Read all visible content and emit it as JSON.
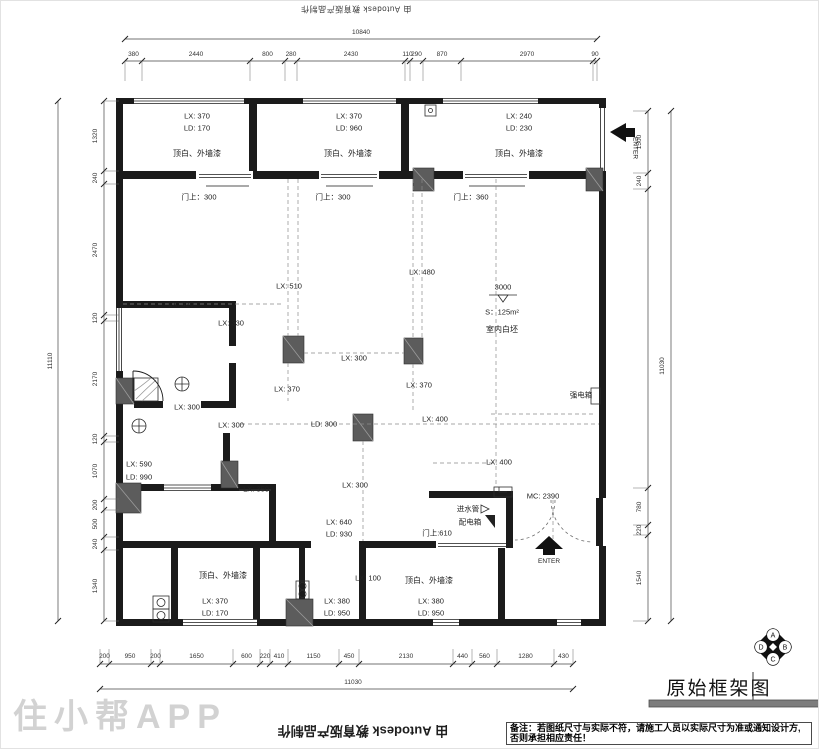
{
  "colors": {
    "wall": "#1b1b1b",
    "column": "#5c5c5c",
    "dimension": "#444444",
    "dashed_ref": "#8a8a8a",
    "title_bar": "#7d7d7d",
    "watermark": "#d2d2d2"
  },
  "watermarks": {
    "autodesk": "由 Autodesk 教育版产品制作",
    "app": "住小帮APP"
  },
  "title_block": {
    "title": "原始框架图",
    "logo_letters": [
      "A",
      "B",
      "C",
      "D"
    ],
    "note": "备注：若图纸尺寸与实际不符，请施工人员以实际尺寸为准或通知设计方,否则承担相应责任！"
  },
  "dimensions": {
    "top": {
      "total": "10840",
      "segments": [
        "380",
        "2440",
        "800",
        "280",
        "2430",
        "110",
        "290",
        "870",
        "2970",
        "90"
      ]
    },
    "bottom": {
      "total": "11030",
      "segments": [
        "200",
        "950",
        "200",
        "1650",
        "600",
        "220",
        "410",
        "1150",
        "450",
        "2130",
        "440",
        "560",
        "1280",
        "430"
      ]
    },
    "left": {
      "total": "11110",
      "segments": [
        "1320",
        "240",
        "2470",
        "120",
        "2170",
        "120",
        "1070",
        "200",
        "500",
        "240",
        "1340"
      ]
    },
    "right": {
      "total": "11030",
      "segments": [
        "1500",
        "240",
        "",
        "780",
        "220",
        "1540"
      ]
    }
  },
  "plan_labels": [
    {
      "name": "room1-lx",
      "t": "LX: 370",
      "x": 196,
      "y": 115
    },
    {
      "name": "room1-ld",
      "t": "LD: 170",
      "x": 196,
      "y": 127
    },
    {
      "name": "room1-finish",
      "t": "顶白、外墙漆",
      "x": 196,
      "y": 153,
      "size": 8
    },
    {
      "name": "room1-door-height",
      "t": "门上：300",
      "x": 198,
      "y": 196
    },
    {
      "name": "room2-lx",
      "t": "LX: 370",
      "x": 348,
      "y": 115
    },
    {
      "name": "room2-ld",
      "t": "LD: 960",
      "x": 348,
      "y": 127
    },
    {
      "name": "room2-finish",
      "t": "顶白、外墙漆",
      "x": 347,
      "y": 153,
      "size": 8
    },
    {
      "name": "room2-door-height",
      "t": "门上：300",
      "x": 332,
      "y": 196
    },
    {
      "name": "room3-lx",
      "t": "LX: 240",
      "x": 518,
      "y": 115
    },
    {
      "name": "room3-ld",
      "t": "LD: 230",
      "x": 518,
      "y": 127
    },
    {
      "name": "room3-finish",
      "t": "顶白、外墙漆",
      "x": 518,
      "y": 153,
      "size": 8
    },
    {
      "name": "room3-door-height",
      "t": "门上：360",
      "x": 470,
      "y": 196
    },
    {
      "name": "enter-top-label",
      "t": "ENTER",
      "x": 633,
      "y": 147,
      "rot": 90,
      "size": 6.5
    },
    {
      "name": "dim-lx-320",
      "t": "LX: 320",
      "x": 180,
      "y": 303
    },
    {
      "name": "dim-lx-330",
      "t": "LX: 330",
      "x": 230,
      "y": 322
    },
    {
      "name": "dim-lx-300-a",
      "t": "LX: 300",
      "x": 186,
      "y": 406
    },
    {
      "name": "dim-lx-300-b",
      "t": "LX: 300",
      "x": 230,
      "y": 424
    },
    {
      "name": "dim-lx-590",
      "t": "LX: 590",
      "x": 138,
      "y": 463
    },
    {
      "name": "dim-ld-990",
      "t": "LD: 990",
      "x": 138,
      "y": 476
    },
    {
      "name": "dim-lx-350",
      "t": "LX: 350",
      "x": 255,
      "y": 488
    },
    {
      "name": "dim-lx-510",
      "t": "LX: 510",
      "x": 288,
      "y": 285
    },
    {
      "name": "dim-lx-480",
      "t": "LX: 480",
      "x": 421,
      "y": 271
    },
    {
      "name": "dim-lx-300-mid",
      "t": "LX: 300",
      "x": 353,
      "y": 357
    },
    {
      "name": "dim-lx-370-c1",
      "t": "LX: 370",
      "x": 286,
      "y": 388
    },
    {
      "name": "dim-lx-370-c2",
      "t": "LX: 370",
      "x": 418,
      "y": 384
    },
    {
      "name": "elevation-value",
      "t": "3000",
      "x": 502,
      "y": 286
    },
    {
      "name": "area-value",
      "t": "S：125m²",
      "x": 501,
      "y": 311
    },
    {
      "name": "interior-finish",
      "t": "室内白坯",
      "x": 501,
      "y": 329,
      "size": 8
    },
    {
      "name": "dim-ld-300",
      "t": "LD: 300",
      "x": 323,
      "y": 423
    },
    {
      "name": "dim-lx-400-a",
      "t": "LX: 400",
      "x": 434,
      "y": 418
    },
    {
      "name": "dim-lx-400-b",
      "t": "LX: 400",
      "x": 498,
      "y": 461
    },
    {
      "name": "dim-lx-300-c",
      "t": "LX: 300",
      "x": 354,
      "y": 484
    },
    {
      "name": "dim-lx-640",
      "t": "LX: 640",
      "x": 338,
      "y": 521
    },
    {
      "name": "dim-ld-930",
      "t": "LD: 930",
      "x": 338,
      "y": 533
    },
    {
      "name": "door-height-610",
      "t": "门上:610",
      "x": 436,
      "y": 532
    },
    {
      "name": "water-inlet-label",
      "t": "进水管",
      "x": 467,
      "y": 508
    },
    {
      "name": "distribution-box-label",
      "t": "配电箱",
      "x": 469,
      "y": 521
    },
    {
      "name": "dim-mc-2390",
      "t": "MC: 2390",
      "x": 542,
      "y": 495
    },
    {
      "name": "strong-electric-box-label",
      "t": "强电箱",
      "x": 580,
      "y": 394
    },
    {
      "name": "enter-bottom-label",
      "t": "ENTER",
      "x": 548,
      "y": 561,
      "size": 6.5
    },
    {
      "name": "room4-finish",
      "t": "顶白、外墙漆",
      "x": 222,
      "y": 575,
      "size": 8
    },
    {
      "name": "room4-lx",
      "t": "LX: 370",
      "x": 214,
      "y": 600
    },
    {
      "name": "room4-ld",
      "t": "LD: 170",
      "x": 214,
      "y": 612
    },
    {
      "name": "room5-lx",
      "t": "LX: 380",
      "x": 336,
      "y": 600
    },
    {
      "name": "room5-ld",
      "t": "LD: 950",
      "x": 336,
      "y": 612
    },
    {
      "name": "dim-lx-100",
      "t": "LX: 100",
      "x": 367,
      "y": 577
    },
    {
      "name": "room6-finish",
      "t": "顶白、外墙漆",
      "x": 428,
      "y": 580,
      "size": 8
    },
    {
      "name": "room6-lx",
      "t": "LX: 380",
      "x": 430,
      "y": 600
    },
    {
      "name": "room6-ld",
      "t": "LD: 950",
      "x": 430,
      "y": 612
    }
  ]
}
